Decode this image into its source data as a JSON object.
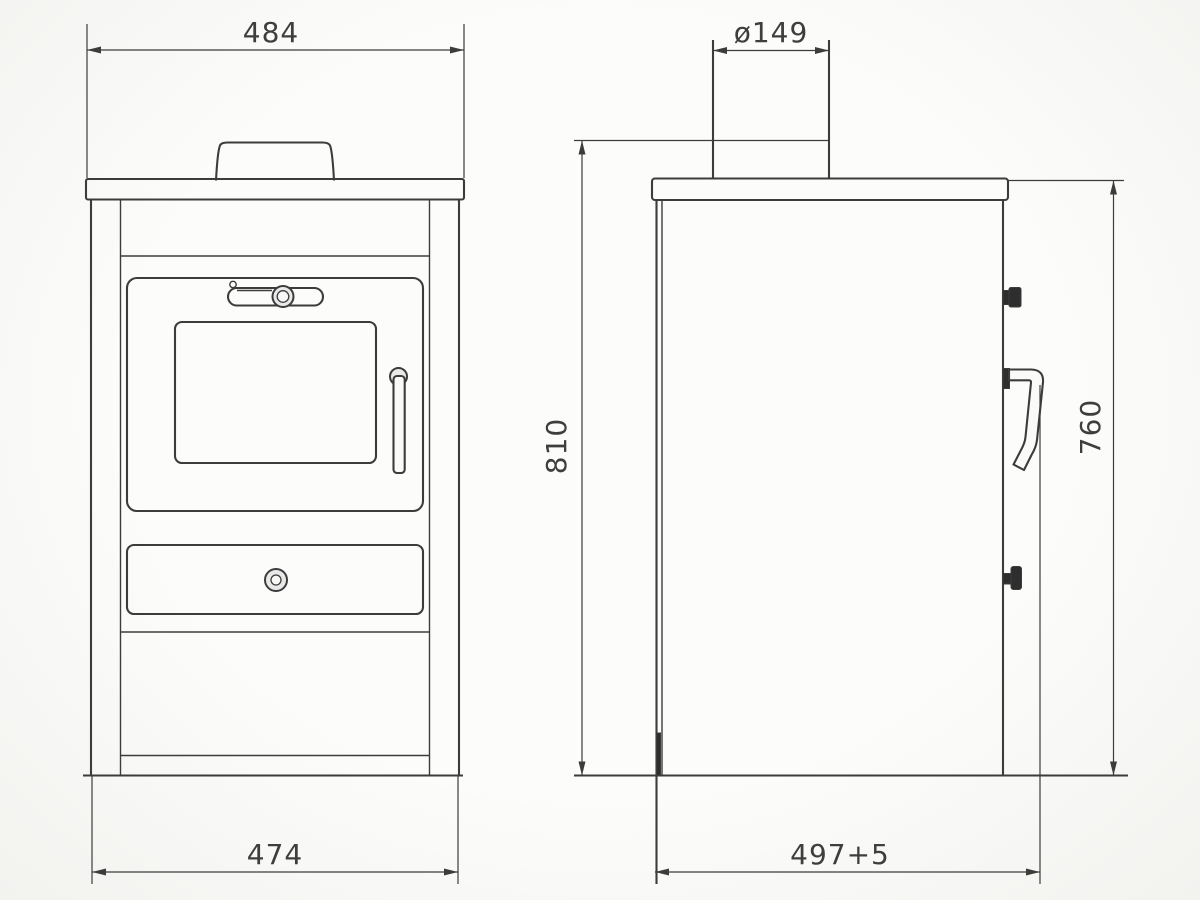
{
  "drawing": {
    "dimensions": {
      "front_top_width": "484",
      "flue_diameter": "ø149",
      "overall_height": "810",
      "rear_height": "760",
      "front_bottom_width": "474",
      "depth": "497+5"
    },
    "colors": {
      "line": "#3c3c3c",
      "knob": "#2e2e2e",
      "text": "#3e3e3e",
      "background": "#fafaf8",
      "ring_fill": "#e9e9e9"
    }
  }
}
